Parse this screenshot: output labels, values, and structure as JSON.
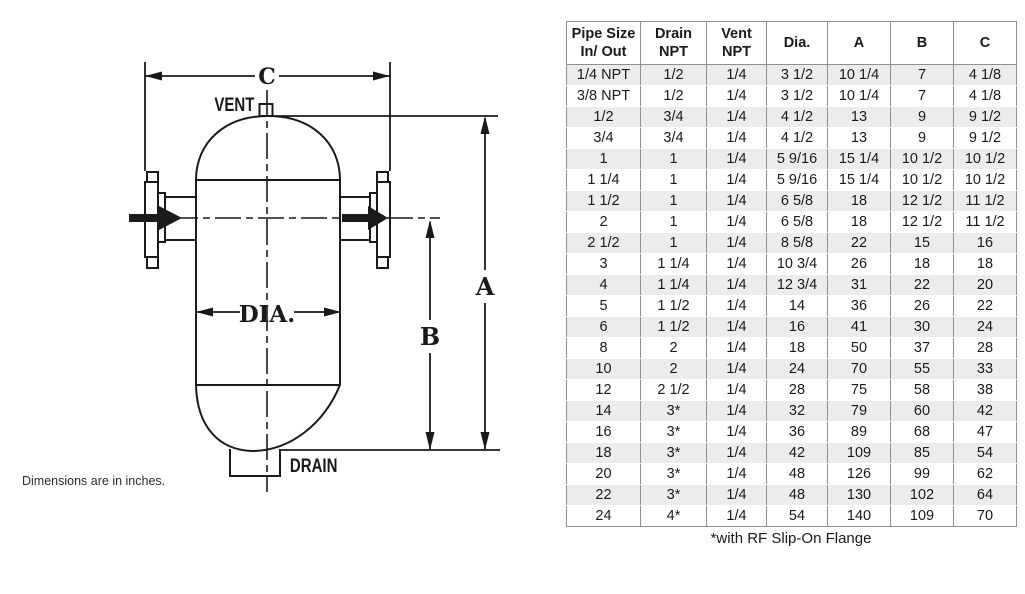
{
  "diagram": {
    "labels": {
      "vent": "VENT",
      "drain": "DRAIN",
      "dia": "DIA.",
      "dim_a": "A",
      "dim_b": "B",
      "dim_c": "C"
    },
    "note": "Dimensions are in inches.",
    "line_color": "#1a1a1a"
  },
  "table": {
    "columns": [
      {
        "lines": [
          "Pipe Size",
          "In/ Out"
        ]
      },
      {
        "lines": [
          "Drain",
          "NPT"
        ]
      },
      {
        "lines": [
          "Vent",
          "NPT"
        ]
      },
      {
        "lines": [
          "Dia."
        ]
      },
      {
        "lines": [
          "A"
        ]
      },
      {
        "lines": [
          "B"
        ]
      },
      {
        "lines": [
          "C"
        ]
      }
    ],
    "rows": [
      [
        "1/4 NPT",
        "1/2",
        "1/4",
        "3 1/2",
        "10 1/4",
        "7",
        "4 1/8"
      ],
      [
        "3/8 NPT",
        "1/2",
        "1/4",
        "3 1/2",
        "10 1/4",
        "7",
        "4 1/8"
      ],
      [
        "1/2",
        "3/4",
        "1/4",
        "4 1/2",
        "13",
        "9",
        "9 1/2"
      ],
      [
        "3/4",
        "3/4",
        "1/4",
        "4 1/2",
        "13",
        "9",
        "9 1/2"
      ],
      [
        "1",
        "1",
        "1/4",
        "5 9/16",
        "15 1/4",
        "10 1/2",
        "10 1/2"
      ],
      [
        "1 1/4",
        "1",
        "1/4",
        "5 9/16",
        "15 1/4",
        "10 1/2",
        "10 1/2"
      ],
      [
        "1 1/2",
        "1",
        "1/4",
        "6 5/8",
        "18",
        "12 1/2",
        "11 1/2"
      ],
      [
        "2",
        "1",
        "1/4",
        "6 5/8",
        "18",
        "12 1/2",
        "11 1/2"
      ],
      [
        "2 1/2",
        "1",
        "1/4",
        "8 5/8",
        "22",
        "15",
        "16"
      ],
      [
        "3",
        "1 1/4",
        "1/4",
        "10 3/4",
        "26",
        "18",
        "18"
      ],
      [
        "4",
        "1 1/4",
        "1/4",
        "12 3/4",
        "31",
        "22",
        "20"
      ],
      [
        "5",
        "1 1/2",
        "1/4",
        "14",
        "36",
        "26",
        "22"
      ],
      [
        "6",
        "1 1/2",
        "1/4",
        "16",
        "41",
        "30",
        "24"
      ],
      [
        "8",
        "2",
        "1/4",
        "18",
        "50",
        "37",
        "28"
      ],
      [
        "10",
        "2",
        "1/4",
        "24",
        "70",
        "55",
        "33"
      ],
      [
        "12",
        "2 1/2",
        "1/4",
        "28",
        "75",
        "58",
        "38"
      ],
      [
        "14",
        "3*",
        "1/4",
        "32",
        "79",
        "60",
        "42"
      ],
      [
        "16",
        "3*",
        "1/4",
        "36",
        "89",
        "68",
        "47"
      ],
      [
        "18",
        "3*",
        "1/4",
        "42",
        "109",
        "85",
        "54"
      ],
      [
        "20",
        "3*",
        "1/4",
        "48",
        "126",
        "99",
        "62"
      ],
      [
        "22",
        "3*",
        "1/4",
        "48",
        "130",
        "102",
        "64"
      ],
      [
        "24",
        "4*",
        "1/4",
        "54",
        "140",
        "109",
        "70"
      ]
    ],
    "footnote": "*with RF Slip-On Flange",
    "colors": {
      "stripe": "#ececec",
      "border": "#8f8f8f",
      "header_bg": "#ffffff",
      "text": "#1a1a1a"
    }
  }
}
